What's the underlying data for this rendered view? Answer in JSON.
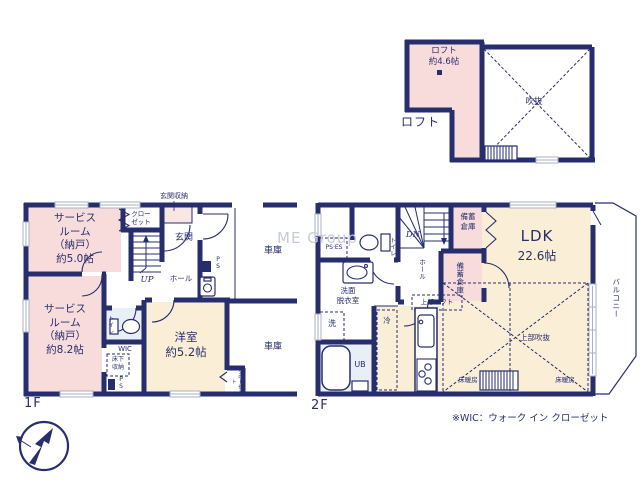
{
  "watermark": "ME Group",
  "footnote": "※WIC：ウォーク イン クローゼット",
  "colors": {
    "wall": "#272e6e",
    "room_pink": "#f8dcdc",
    "room_cream": "#faeed6",
    "room_pale_blue": "#e9eff7",
    "window_gray": "#a7b0c4",
    "watermark_gray": "#c9cbd6",
    "text": "#272e6e"
  },
  "floor1": {
    "label": "1F",
    "service_room_a": "サービス\nルーム\n（納戸）\n約5.0帖",
    "service_room_b": "サービス\nルーム\n（納戸）\n約8.2帖",
    "closet_top": "クロー\nゼット",
    "entrance_storage": "玄関収納",
    "entrance": "玄関",
    "up": "UP",
    "hall": "ホール",
    "ps_entrance": "P\nS",
    "toilet": "トイレ",
    "wic": "WIC",
    "underfloor_storage": "床下\n収納",
    "ps_wic": "P\nS",
    "western_room": "洋室\n約5.2帖",
    "closet_side": "クローゼット",
    "garage_upper": "車庫",
    "garage_lower": "車庫"
  },
  "floor2": {
    "label": "2F",
    "dn": "DN",
    "hall": "ホール",
    "toilet": "トイレ",
    "ps_es": "PS·ES",
    "washroom": "洗面\n脱衣室",
    "washer": "洗",
    "unit_bath": "UB",
    "fridge": "冷",
    "storage_a": "備蓄\n倉庫",
    "storage_b": "備蓄倉庫",
    "ldk_name": "LDK",
    "ldk_size": "22.6帖",
    "upper_loft": "上部ロフト",
    "upper_void": "上部吹抜",
    "floor_heating_left": "床暖房",
    "floor_heating_right": "床暖房",
    "balcony": "バルコニー"
  },
  "loft": {
    "label": "ロフト",
    "room": "ロフト\n約4.6帖",
    "void": "吹抜"
  }
}
